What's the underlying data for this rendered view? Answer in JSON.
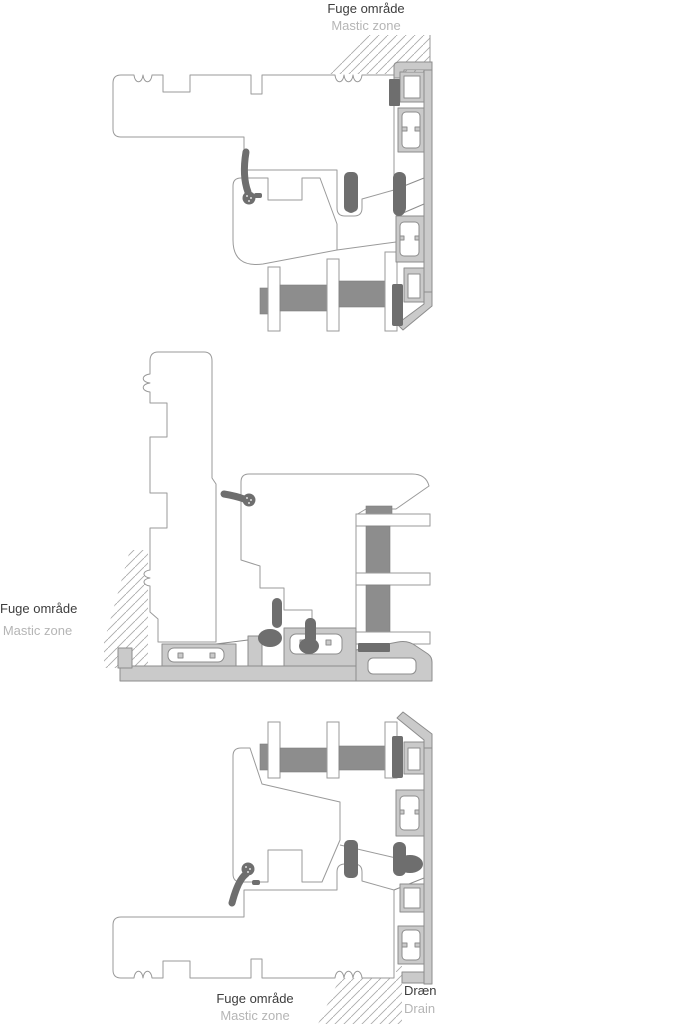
{
  "document": {
    "type": "window-frame-cross-sections",
    "sections": [
      "head-section",
      "jamb-section",
      "sill-section"
    ]
  },
  "labels": {
    "top_mastic": {
      "primary": "Fuge område",
      "secondary": "Mastic zone"
    },
    "left_mastic": {
      "primary": "Fuge område",
      "secondary": "Mastic zone"
    },
    "bottom_mastic": {
      "primary": "Fuge område",
      "secondary": "Mastic zone"
    },
    "drain": {
      "primary": "Dræn",
      "secondary": "Drain"
    }
  },
  "colors": {
    "outline": "#9a9a9a",
    "aluminum_fill": "#cacaca",
    "aluminum_outline": "#8c8c8c",
    "gasket": "#6e6e6e",
    "glazing_spacer": "#8d8d8d",
    "hatch_line": "#ababab",
    "label_primary": "#3d3d3d",
    "label_secondary": "#b5b5b5",
    "background": "#ffffff"
  }
}
